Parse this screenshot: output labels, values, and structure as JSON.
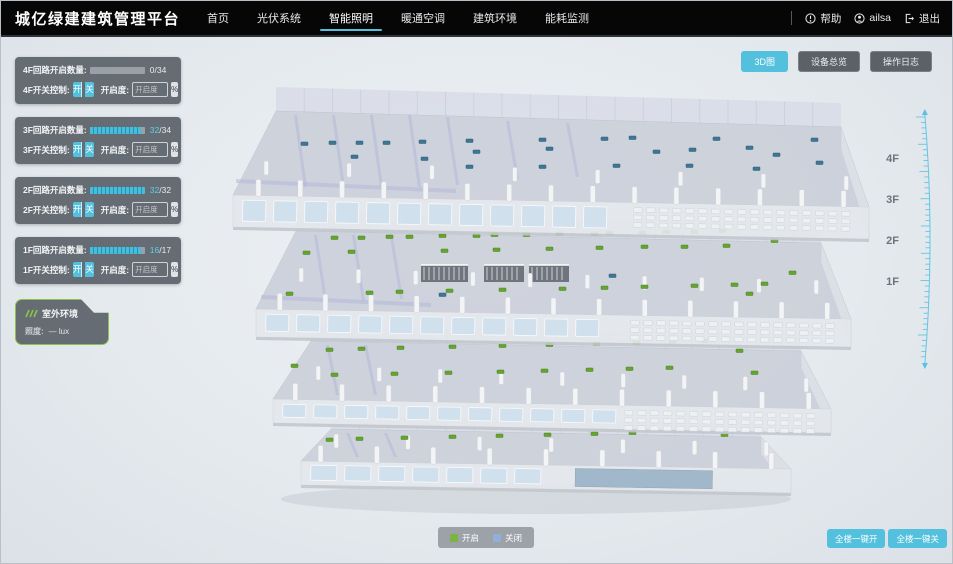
{
  "app": {
    "title": "城亿绿建建筑管理平台"
  },
  "nav": {
    "items": [
      {
        "label": "首页",
        "active": false
      },
      {
        "label": "光伏系统",
        "active": false
      },
      {
        "label": "智能照明",
        "active": true
      },
      {
        "label": "暖通空调",
        "active": false
      },
      {
        "label": "建筑环境",
        "active": false
      },
      {
        "label": "能耗监测",
        "active": false
      }
    ],
    "help_label": "帮助",
    "username": "ailsa",
    "logout_label": "退出"
  },
  "view_buttons": [
    {
      "label": "3D图",
      "active": true
    },
    {
      "label": "设备总览",
      "active": false
    },
    {
      "label": "操作日志",
      "active": false
    }
  ],
  "floor_panels": [
    {
      "floor": "4F",
      "circuit_label": "4F回路开启数量:",
      "open": "0",
      "count_sep": "/",
      "total": "34",
      "progress": 0,
      "switch_label": "4F开关控制:",
      "on_label": "开",
      "off_label": "关",
      "dim_label": "开启度:",
      "dim_placeholder": "开启度",
      "percent_label": "%"
    },
    {
      "floor": "3F",
      "circuit_label": "3F回路开启数量:",
      "open": "32",
      "count_sep": "/",
      "total": "34",
      "progress": 94,
      "switch_label": "3F开关控制:",
      "on_label": "开",
      "off_label": "关",
      "dim_label": "开启度:",
      "dim_placeholder": "开启度",
      "percent_label": "%"
    },
    {
      "floor": "2F",
      "circuit_label": "2F回路开启数量:",
      "open": "32",
      "count_sep": "/",
      "total": "32",
      "progress": 100,
      "switch_label": "2F开关控制:",
      "on_label": "开",
      "off_label": "关",
      "dim_label": "开启度:",
      "dim_placeholder": "开启度",
      "percent_label": "%"
    },
    {
      "floor": "1F",
      "circuit_label": "1F回路开启数量:",
      "open": "16",
      "count_sep": "/",
      "total": "17",
      "progress": 94,
      "switch_label": "1F开关控制:",
      "on_label": "开",
      "off_label": "关",
      "dim_label": "开启度:",
      "dim_placeholder": "开启度",
      "percent_label": "%"
    }
  ],
  "outdoor": {
    "title": "室外环境",
    "illuminance_label": "照度:",
    "illuminance_value": "— lux"
  },
  "floor_axis": [
    "4F",
    "3F",
    "2F",
    "1F"
  ],
  "legend": [
    {
      "label": "开启",
      "color": "#7cb342"
    },
    {
      "label": "关闭",
      "color": "#8fb0d8"
    }
  ],
  "bulk_buttons": [
    {
      "label": "全楼一键开"
    },
    {
      "label": "全楼一键关"
    }
  ],
  "colors": {
    "accent": "#53c0dd",
    "marker_on": "#64a52e",
    "marker_off": "#3e7795"
  }
}
